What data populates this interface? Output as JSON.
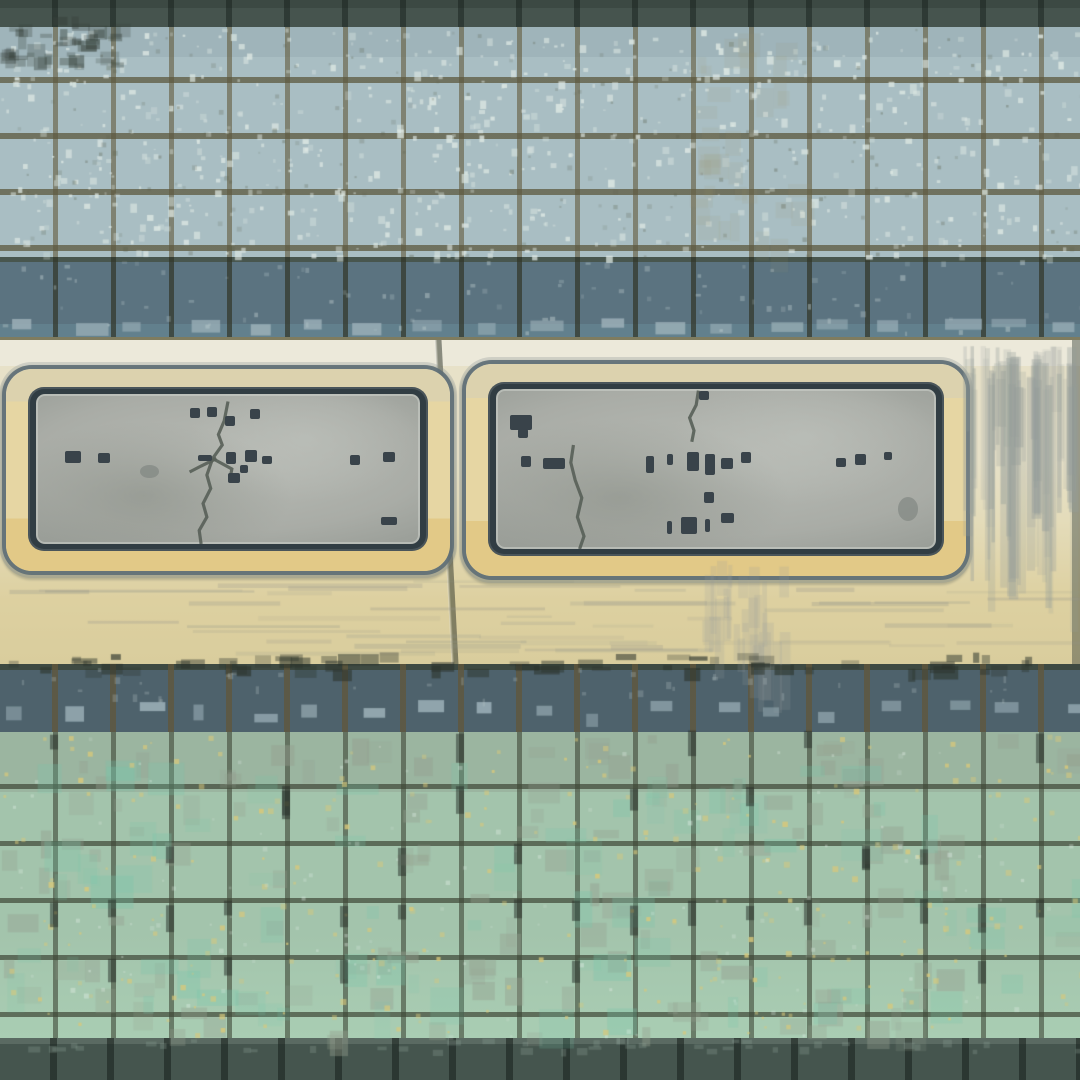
{
  "scene": {
    "description": "Weathered ceramic subway-style tile wall with two corroded blank metal plaques mounted on a cream stone band",
    "visible_text": "",
    "plaque_text_legibility": "illegible weathered markings only"
  },
  "colors": {
    "top_band": "#46544e",
    "upper_tile": "#a9bec3",
    "grout": "#6f6b52",
    "slate_tile": "#5b7380",
    "slate_tile_lower": "#4e626c",
    "slate_highlight": "#9db3bb",
    "cream_light": "#ece9da",
    "cream_mid": "#e4dcba",
    "cream_yellow": "#ddd0a0",
    "frame": "#e6d6a3",
    "frame_gold": "#e2c987",
    "border_dark": "#313d43",
    "plate": "#a9aca6",
    "plate_light": "#b7bab4",
    "plate_shade": "#8f948e",
    "mark": "#39434a",
    "green_tile": "#a3c4ac",
    "green_gray": "#97a698",
    "yellow_speck": "#d8c87c",
    "bottom_band": "#45554e",
    "stain": "#9aa4a0"
  },
  "plaques": {
    "left": {
      "condition": "cracked, stained, illegible",
      "marks": [
        {
          "x": 40,
          "y": 9,
          "w": 2.6,
          "h": 6.7
        },
        {
          "x": 44.5,
          "y": 8.7,
          "w": 2.6,
          "h": 6.7
        },
        {
          "x": 49.2,
          "y": 14.7,
          "w": 2.6,
          "h": 6.7
        },
        {
          "x": 55.7,
          "y": 10,
          "w": 2.6,
          "h": 6.7
        },
        {
          "x": 7.6,
          "y": 38,
          "w": 4.2,
          "h": 8
        },
        {
          "x": 16.1,
          "y": 39.3,
          "w": 3.1,
          "h": 6.7
        },
        {
          "x": 42.2,
          "y": 40.7,
          "w": 3.6,
          "h": 4
        },
        {
          "x": 49.5,
          "y": 38.7,
          "w": 2.6,
          "h": 8
        },
        {
          "x": 54.4,
          "y": 37.3,
          "w": 3.1,
          "h": 8
        },
        {
          "x": 58.9,
          "y": 41.3,
          "w": 2.6,
          "h": 5.3
        },
        {
          "x": 50,
          "y": 52.7,
          "w": 3.1,
          "h": 6.7
        },
        {
          "x": 53.1,
          "y": 47.3,
          "w": 2.1,
          "h": 5.3
        },
        {
          "x": 81.8,
          "y": 40.7,
          "w": 2.6,
          "h": 6.7
        },
        {
          "x": 90.4,
          "y": 38.7,
          "w": 3.1,
          "h": 6.7
        },
        {
          "x": 89.8,
          "y": 82,
          "w": 4.2,
          "h": 5.3
        },
        {
          "x": 27,
          "y": 47,
          "w": 5,
          "h": 9,
          "soft": true
        }
      ],
      "cracks": [
        "50,5 49,18 47.5,27 48.5,34 46,43 44.5,54 45.5,63 43.5,73 44.5,82 42.5,91 43,100",
        "47,43 43,48 40,52",
        "46,43 51,50 50.5,57"
      ]
    },
    "right": {
      "condition": "cracked, stained, illegible",
      "marks": [
        {
          "x": 3.2,
          "y": 16.2,
          "w": 5,
          "h": 9.5
        },
        {
          "x": 5,
          "y": 25,
          "w": 2.3,
          "h": 5.4
        },
        {
          "x": 5.7,
          "y": 41.9,
          "w": 2.3,
          "h": 6.8
        },
        {
          "x": 10.7,
          "y": 43.2,
          "w": 5,
          "h": 6.8
        },
        {
          "x": 34.2,
          "y": 41.9,
          "w": 1.8,
          "h": 10.8
        },
        {
          "x": 38.8,
          "y": 40.5,
          "w": 1.4,
          "h": 6.8
        },
        {
          "x": 43.4,
          "y": 39.2,
          "w": 2.7,
          "h": 12.2
        },
        {
          "x": 47.5,
          "y": 40.5,
          "w": 2.3,
          "h": 13.5
        },
        {
          "x": 51.1,
          "y": 43.2,
          "w": 2.7,
          "h": 6.8
        },
        {
          "x": 55.7,
          "y": 39.2,
          "w": 2.3,
          "h": 6.8
        },
        {
          "x": 77.2,
          "y": 43.2,
          "w": 2.3,
          "h": 5.4
        },
        {
          "x": 81.5,
          "y": 40.5,
          "w": 2.7,
          "h": 6.8
        },
        {
          "x": 88.1,
          "y": 39.2,
          "w": 1.8,
          "h": 5.4
        },
        {
          "x": 47.3,
          "y": 64.2,
          "w": 2.3,
          "h": 6.8
        },
        {
          "x": 38.8,
          "y": 82.4,
          "w": 1.1,
          "h": 8.1
        },
        {
          "x": 42,
          "y": 79.7,
          "w": 3.7,
          "h": 10.8
        },
        {
          "x": 47.5,
          "y": 81.1,
          "w": 1.1,
          "h": 8.1
        },
        {
          "x": 51.1,
          "y": 77.7,
          "w": 3,
          "h": 6.1
        },
        {
          "x": 46.1,
          "y": 1.4,
          "w": 2.3,
          "h": 5.4
        },
        {
          "x": 91.3,
          "y": 67.6,
          "w": 4.6,
          "h": 14.9,
          "soft": true
        }
      ],
      "cracks": [
        "46,1 45.5,10 44,18 45,26 44.5,33",
        "17.6,35 17,46 18,57 19.5,68 18.5,80 20,92 19,100"
      ]
    }
  }
}
